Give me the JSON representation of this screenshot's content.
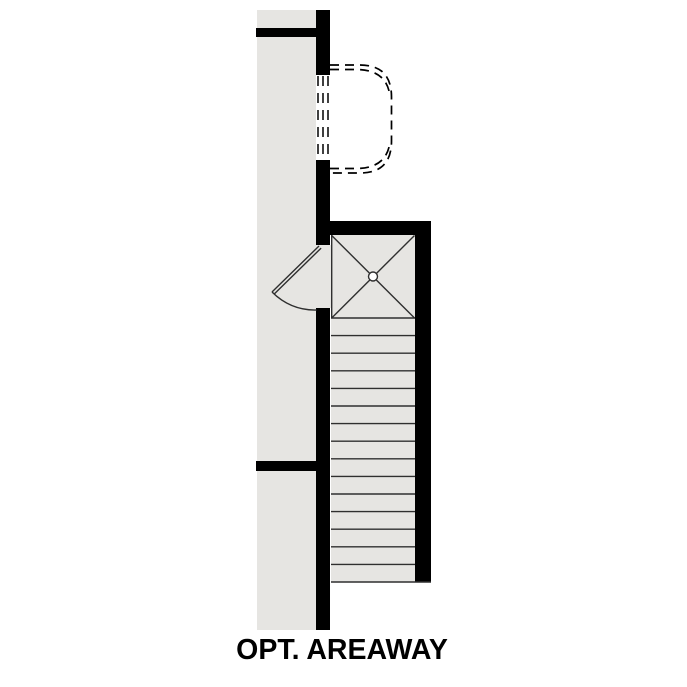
{
  "title": {
    "text": "OPT. AREAWAY"
  },
  "colors": {
    "background": "#ffffff",
    "floor": "#e6e5e2",
    "wall": "#000000",
    "line": "#2f2f2f",
    "dash": "#000000",
    "text": "#000000"
  },
  "plan": {
    "drawing_type": "floor-plan-detail",
    "stair_tread_count": 15,
    "window_dash_line_count": 3,
    "visible_symbols": [
      "dashed areaway window well",
      "window opening dashes",
      "door swing",
      "stair landing with X",
      "center drain circle",
      "straight stair run"
    ]
  }
}
